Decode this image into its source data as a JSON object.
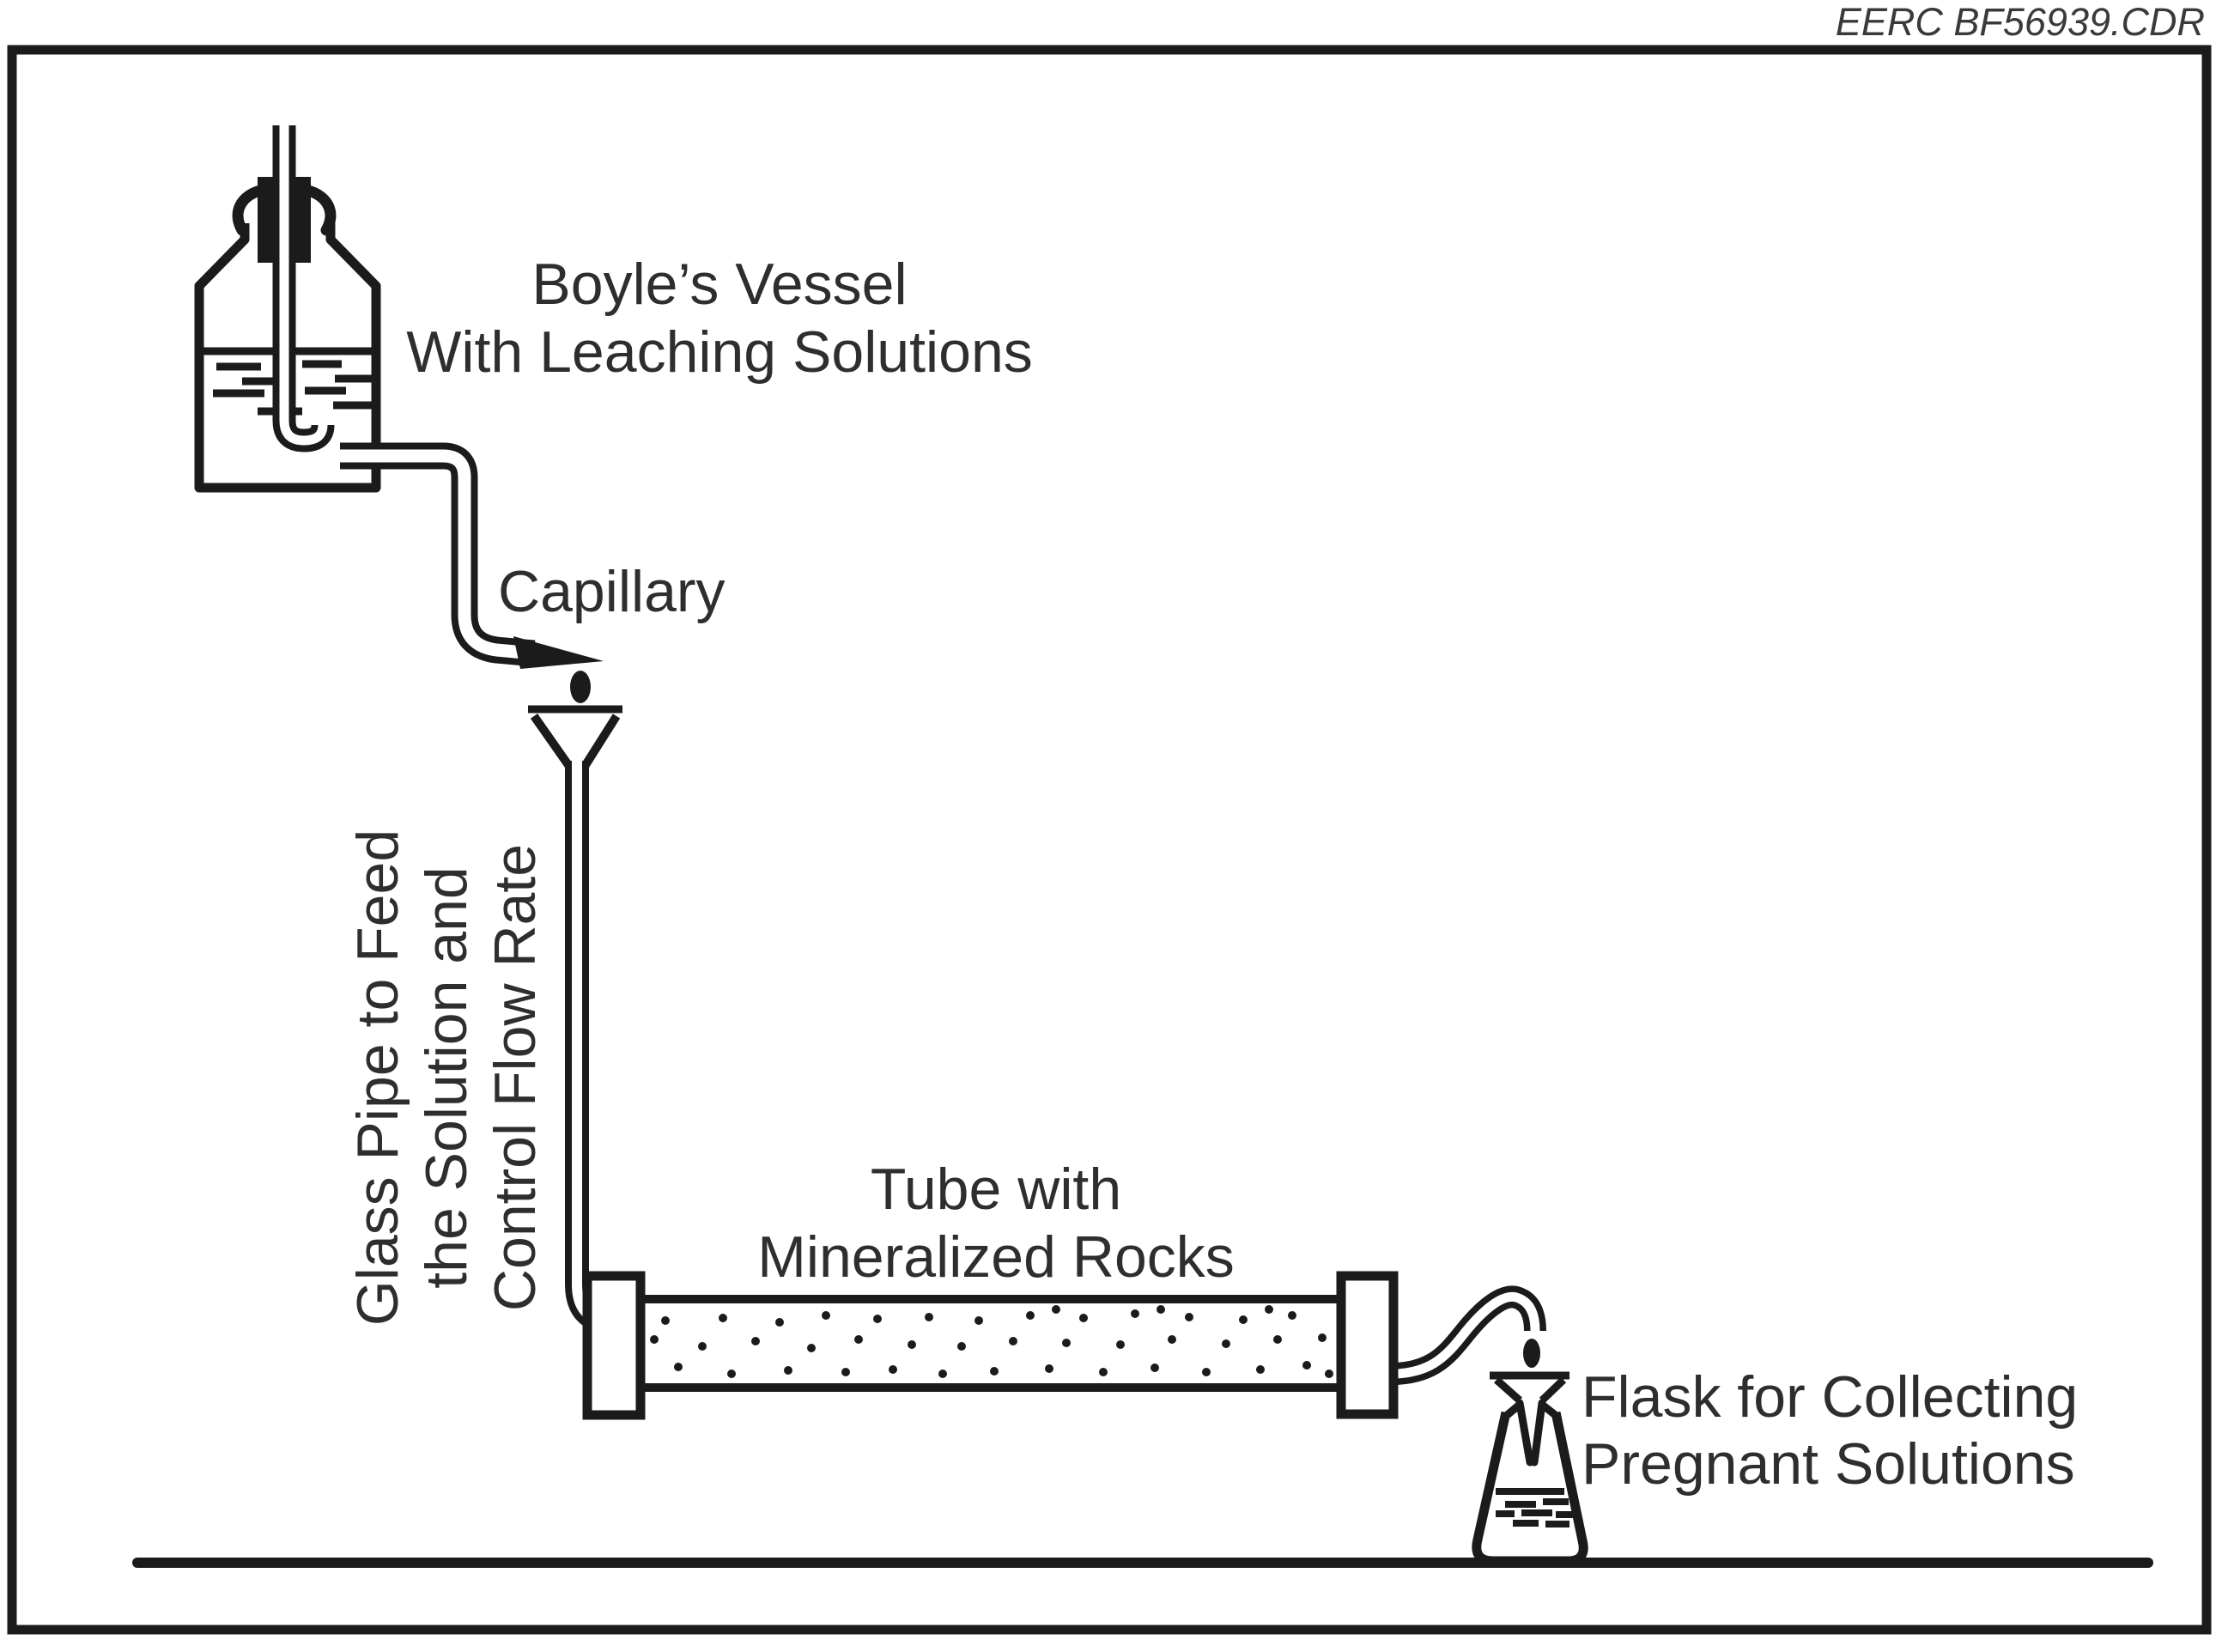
{
  "watermark": "EERC BF56939.CDR",
  "colors": {
    "ink": "#1b1b1b",
    "background": "#ffffff",
    "text": "#2e2e2e"
  },
  "labels": {
    "vessel": {
      "line1": "Boyle’s Vessel",
      "line2": "With Leaching Solutions"
    },
    "capillary": "Capillary",
    "glass_pipe": {
      "line1": "Glass Pipe to Feed",
      "line2": "the Solution and",
      "line3": "Control Flow Rate"
    },
    "tube": {
      "line1": "Tube with",
      "line2": "Mineralized Rocks"
    },
    "flask": {
      "line1": "Flask for Collecting",
      "line2": "Pregnant Solutions"
    }
  },
  "diagram": {
    "rock_dot_radius": 5,
    "rock_dots": [
      [
        762,
        1560
      ],
      [
        775,
        1538
      ],
      [
        790,
        1592
      ],
      [
        818,
        1568
      ],
      [
        842,
        1535
      ],
      [
        852,
        1600
      ],
      [
        880,
        1562
      ],
      [
        908,
        1540
      ],
      [
        918,
        1596
      ],
      [
        945,
        1570
      ],
      [
        962,
        1532
      ],
      [
        985,
        1598
      ],
      [
        1000,
        1560
      ],
      [
        1022,
        1536
      ],
      [
        1040,
        1595
      ],
      [
        1062,
        1566
      ],
      [
        1082,
        1534
      ],
      [
        1098,
        1600
      ],
      [
        1120,
        1568
      ],
      [
        1140,
        1538
      ],
      [
        1158,
        1597
      ],
      [
        1180,
        1562
      ],
      [
        1200,
        1532
      ],
      [
        1222,
        1594
      ],
      [
        1230,
        1525
      ],
      [
        1242,
        1564
      ],
      [
        1262,
        1535
      ],
      [
        1285,
        1598
      ],
      [
        1305,
        1566
      ],
      [
        1322,
        1530
      ],
      [
        1345,
        1593
      ],
      [
        1352,
        1525
      ],
      [
        1365,
        1560
      ],
      [
        1385,
        1534
      ],
      [
        1405,
        1598
      ],
      [
        1428,
        1565
      ],
      [
        1448,
        1537
      ],
      [
        1468,
        1595
      ],
      [
        1478,
        1525
      ],
      [
        1488,
        1560
      ],
      [
        1505,
        1532
      ],
      [
        1522,
        1590
      ],
      [
        1540,
        1558
      ],
      [
        1548,
        1600
      ]
    ],
    "bottle_liquid_dashes": [
      [
        252,
        427,
        52
      ],
      [
        352,
        424,
        46
      ],
      [
        282,
        444,
        56
      ],
      [
        390,
        441,
        50
      ],
      [
        248,
        458,
        60
      ],
      [
        355,
        455,
        48
      ],
      [
        300,
        479,
        52
      ],
      [
        388,
        472,
        50
      ]
    ],
    "flask_liquid_dashes": [
      [
        1753,
        1752,
        36
      ],
      [
        1797,
        1749,
        30
      ],
      [
        1742,
        1763,
        22
      ],
      [
        1772,
        1762,
        36
      ],
      [
        1812,
        1764,
        26
      ],
      [
        1762,
        1774,
        30
      ],
      [
        1800,
        1775,
        28
      ]
    ]
  }
}
